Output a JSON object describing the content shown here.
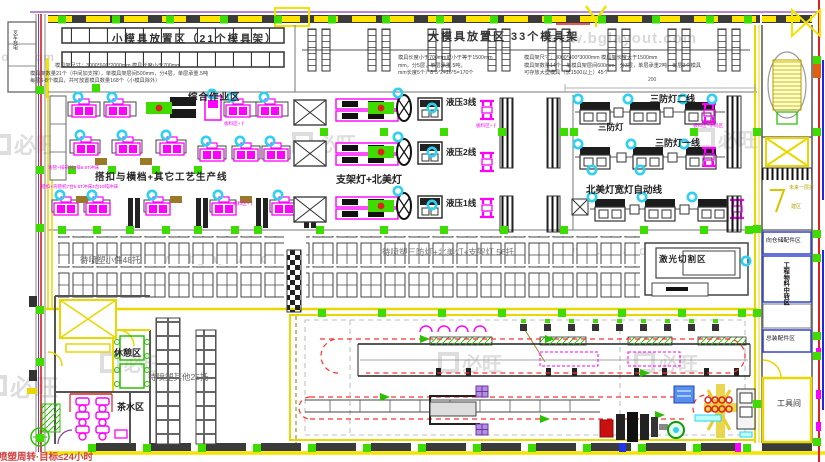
{
  "watermark": {
    "url": "www.bglayout.com",
    "logo": "必旺"
  },
  "zones": {
    "small_mold": {
      "title": "小模具放置区（21个模具架）",
      "spec1": "模具架尺寸：3000*600*2000mm 模具长度小于700mm",
      "spec2": "模具架数量21个（中间加支撑），单模具架层间500mm，分4层，单层承重.5吨",
      "spec3": "每层6-8个模具，共可放置模具数量168个（小模具除外）"
    },
    "large_mold": {
      "title": "大模具放置区  33个模具架",
      "left_spec1": "模具长度小于700mm或小于等于1500mm",
      "left_spec2": "mm，分5层，单层承重.5吨，",
      "left_spec3": "mm长度5个）8*5*2+16*5=170个",
      "right_spec1": "模具架尺寸：3000*400*3000mm 模具架长度大于1500mm",
      "right_spec2": "模具架数量14个，单模具架层间600mm，分3层，单层承重2吨，每层3个模具",
      "right_spec3": "可存放大型模具（长1500以上）45个"
    },
    "work": {
      "title": "综合作业区",
      "board_label": "板料区+∮",
      "board_label2": "板料区+条码区"
    },
    "buckle": {
      "title": "搭扣与横档+其它工艺生产线",
      "note_top": "弯管+排布共2排6.5T冲床",
      "note_bottom": "搭扣+弯管机7台6.5T冲床4台10吨冲床"
    },
    "bracket": {
      "title": "支架灯+北美灯",
      "line3": "液压3线",
      "line2": "液压2线",
      "line1": "液压1线"
    },
    "triproof": {
      "line2": "三防灯二线",
      "mid": "三防灯",
      "line1": "三防灯一线",
      "na_auto": "北美灯宽灯自动线"
    },
    "pallets": {
      "small": "待喷塑小件48托",
      "main": "待喷塑三防灯+北美灯+支架灯 56托",
      "other": "待喷塑其他25托"
    },
    "rooms": {
      "rest": "休憩区",
      "tea": "茶水区",
      "laser": "激光切割区",
      "to_warehouse": "向仓储配件区",
      "transfer": "工程物料中转区",
      "assembly": "总装配件区",
      "tool": "工具间",
      "future_line1": "未来一层扩",
      "future_line2": "建区",
      "forklift": "叉车充电"
    },
    "notes": {
      "spray_target": "喷塑周转·目标≤24小时",
      "dim_200": "200"
    }
  },
  "colors": {
    "wall_yellow": "#f0e000",
    "pillar_green": "#3fdc00",
    "equipment_magenta": "#ff00ff",
    "marker_cyan": "#2fd0f0",
    "path_red": "#ff3030"
  }
}
